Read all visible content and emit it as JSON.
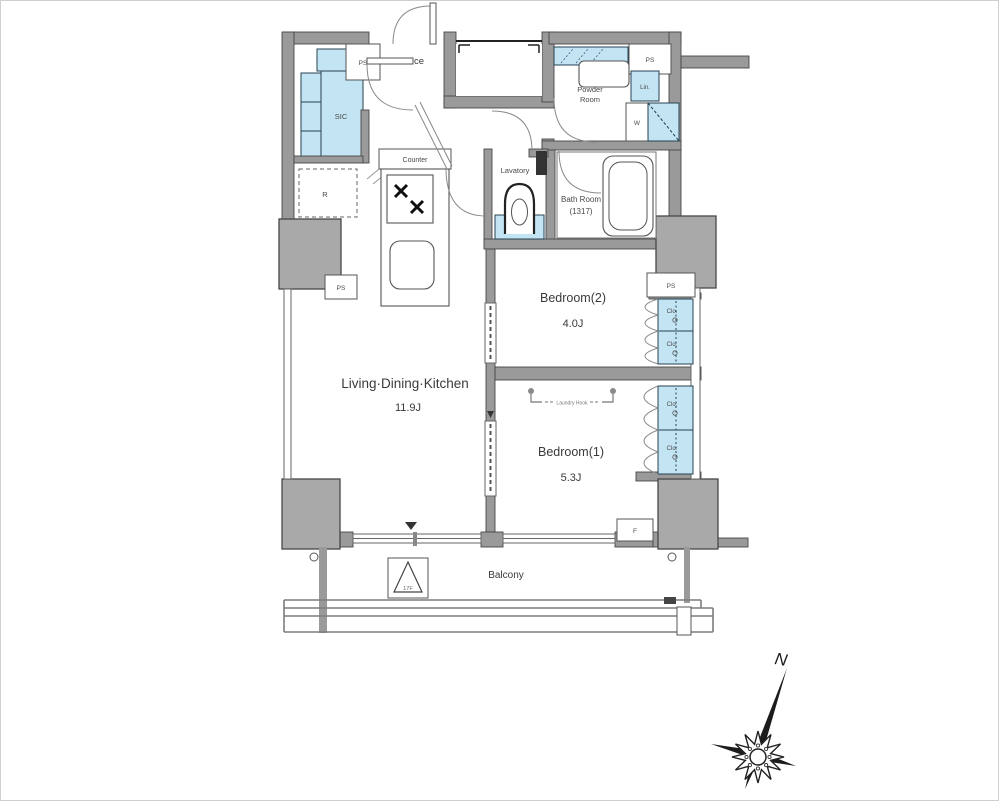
{
  "title": "Apartment floor plan",
  "labels": {
    "entrance": "Entrance",
    "sic": "SIC",
    "ps": "PS",
    "counter": "Counter",
    "refrigerator": "R",
    "powder_room_line1": "Powder",
    "powder_room_line2": "Room",
    "linen": "Lin.",
    "washer": "W",
    "lavatory": "Lavatory",
    "bath_room": "Bath Room",
    "bath_room_size": "(1317)",
    "bedroom2": "Bedroom(2)",
    "bedroom2_size": "4.0J",
    "bedroom1": "Bedroom(1)",
    "bedroom1_size": "5.3J",
    "ldk": "Living·Dining·Kitchen",
    "ldk_size": "11.9J",
    "closet": "Clo.",
    "laundry_hook": "Laundry Hook",
    "balcony": "Balcony",
    "evacuation_hatch": "17F",
    "fire_box": "F",
    "compass_north": "N"
  },
  "colors": {
    "wall": "#9a9a9a",
    "wall_stroke": "#474747",
    "pillar": "#a9a9a9",
    "fixture_blue": "#c3e4f3",
    "blue_stroke": "#24404f",
    "line": "#5a5a5a",
    "text": "#3a3a3a",
    "frame": "#cfcfcf"
  }
}
